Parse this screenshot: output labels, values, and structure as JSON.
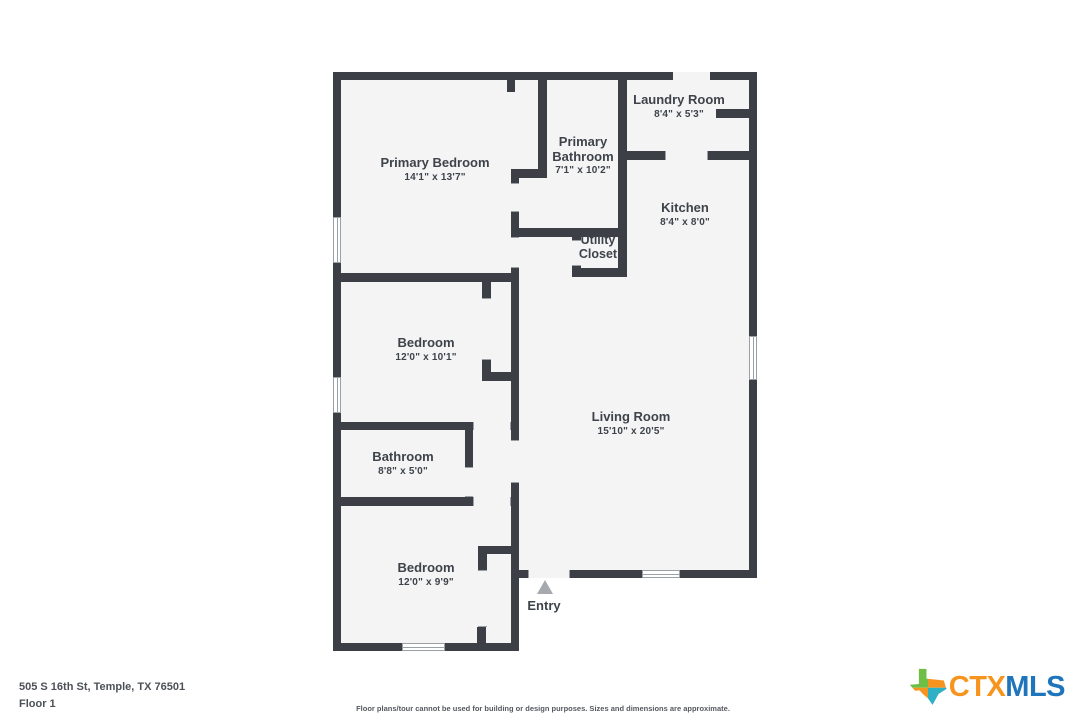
{
  "plan": {
    "rooms": [
      {
        "id": "primary-bedroom",
        "name": "Primary Bedroom",
        "dims": "14'1\" x 13'7\""
      },
      {
        "id": "primary-bathroom",
        "name": "Primary Bathroom",
        "dims": "7'1\" x 10'2\""
      },
      {
        "id": "laundry-room",
        "name": "Laundry Room",
        "dims": "8'4\" x 5'3\""
      },
      {
        "id": "kitchen",
        "name": "Kitchen",
        "dims": "8'4\" x 8'0\""
      },
      {
        "id": "utility-closet",
        "name": "Utility Closet",
        "dims": ""
      },
      {
        "id": "bedroom-2",
        "name": "Bedroom",
        "dims": "12'0\" x 10'1\""
      },
      {
        "id": "living-room",
        "name": "Living Room",
        "dims": "15'10\" x 20'5\""
      },
      {
        "id": "bathroom",
        "name": "Bathroom",
        "dims": "8'8\" x 5'0\""
      },
      {
        "id": "bedroom-3",
        "name": "Bedroom",
        "dims": "12'0\" x 9'9\""
      }
    ],
    "entry_label": "Entry"
  },
  "footer": {
    "address": "505 S 16th St, Temple, TX 76501",
    "floor": "Floor 1",
    "disclaimer": "Floor plans/tour cannot be used for building or design purposes. Sizes and dimensions are approximate."
  },
  "logo": {
    "ctx": "CTX",
    "mls": "MLS"
  },
  "colors": {
    "wall": "#3c4046",
    "floor_fill": "#f4f4f5",
    "logo_orange": "#F7941E",
    "logo_blue": "#1E75BB",
    "logo_green": "#6FBE45",
    "logo_teal": "#2EB0C5"
  }
}
